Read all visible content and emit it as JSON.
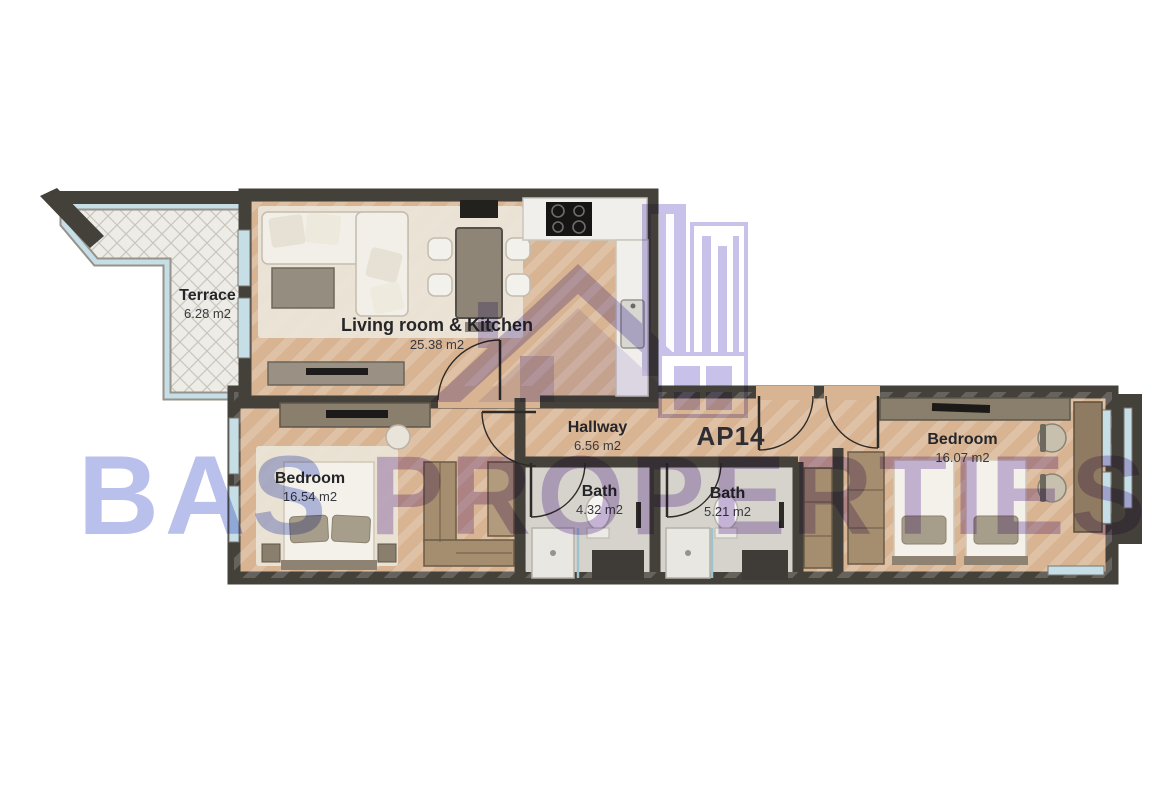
{
  "watermark": {
    "brand_word_1": "BAS",
    "brand_word_2": "PROPERTIES"
  },
  "apartment": {
    "label": "AP14"
  },
  "rooms": [
    {
      "name": "Terrace",
      "area": "6.28 m2"
    },
    {
      "name": "Living room & Kitchen",
      "area": "25.38 m2"
    },
    {
      "name": "Hallway",
      "area": "6.56 m2"
    },
    {
      "name": "Bath",
      "area": "4.32 m2"
    },
    {
      "name": "Bath",
      "area": "5.21 m2"
    },
    {
      "name": "Bedroom",
      "area": "16.54 m2"
    },
    {
      "name": "Bedroom",
      "area": "16.07 m2"
    }
  ],
  "colors": {
    "wall": "#44403a",
    "wood_floor": "#d8b493",
    "bath_floor": "#d6d3cc",
    "terrace_floor": "#eeece7",
    "window_glass": "#c6dfe7",
    "watermark_blue": "#8896de",
    "watermark_purple": "#a88ccd",
    "logo_purple": "#9a8dd6"
  }
}
